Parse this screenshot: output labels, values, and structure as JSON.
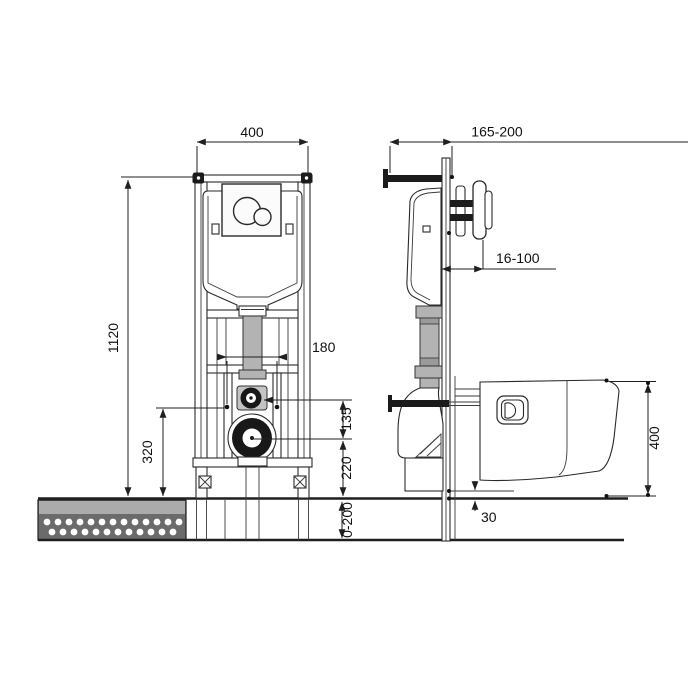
{
  "dimensions": {
    "front": {
      "frame_width": "400",
      "frame_height": "1120",
      "stud_spacing": "180",
      "inlet_to_outlet": "135",
      "outlet_height": "220",
      "stud_height": "320",
      "leg_adjustment": "0-200"
    },
    "side": {
      "frame_depth": "165-200",
      "wall_clearance": "16-100",
      "bowl_height": "400",
      "floor_gap": "30"
    }
  }
}
